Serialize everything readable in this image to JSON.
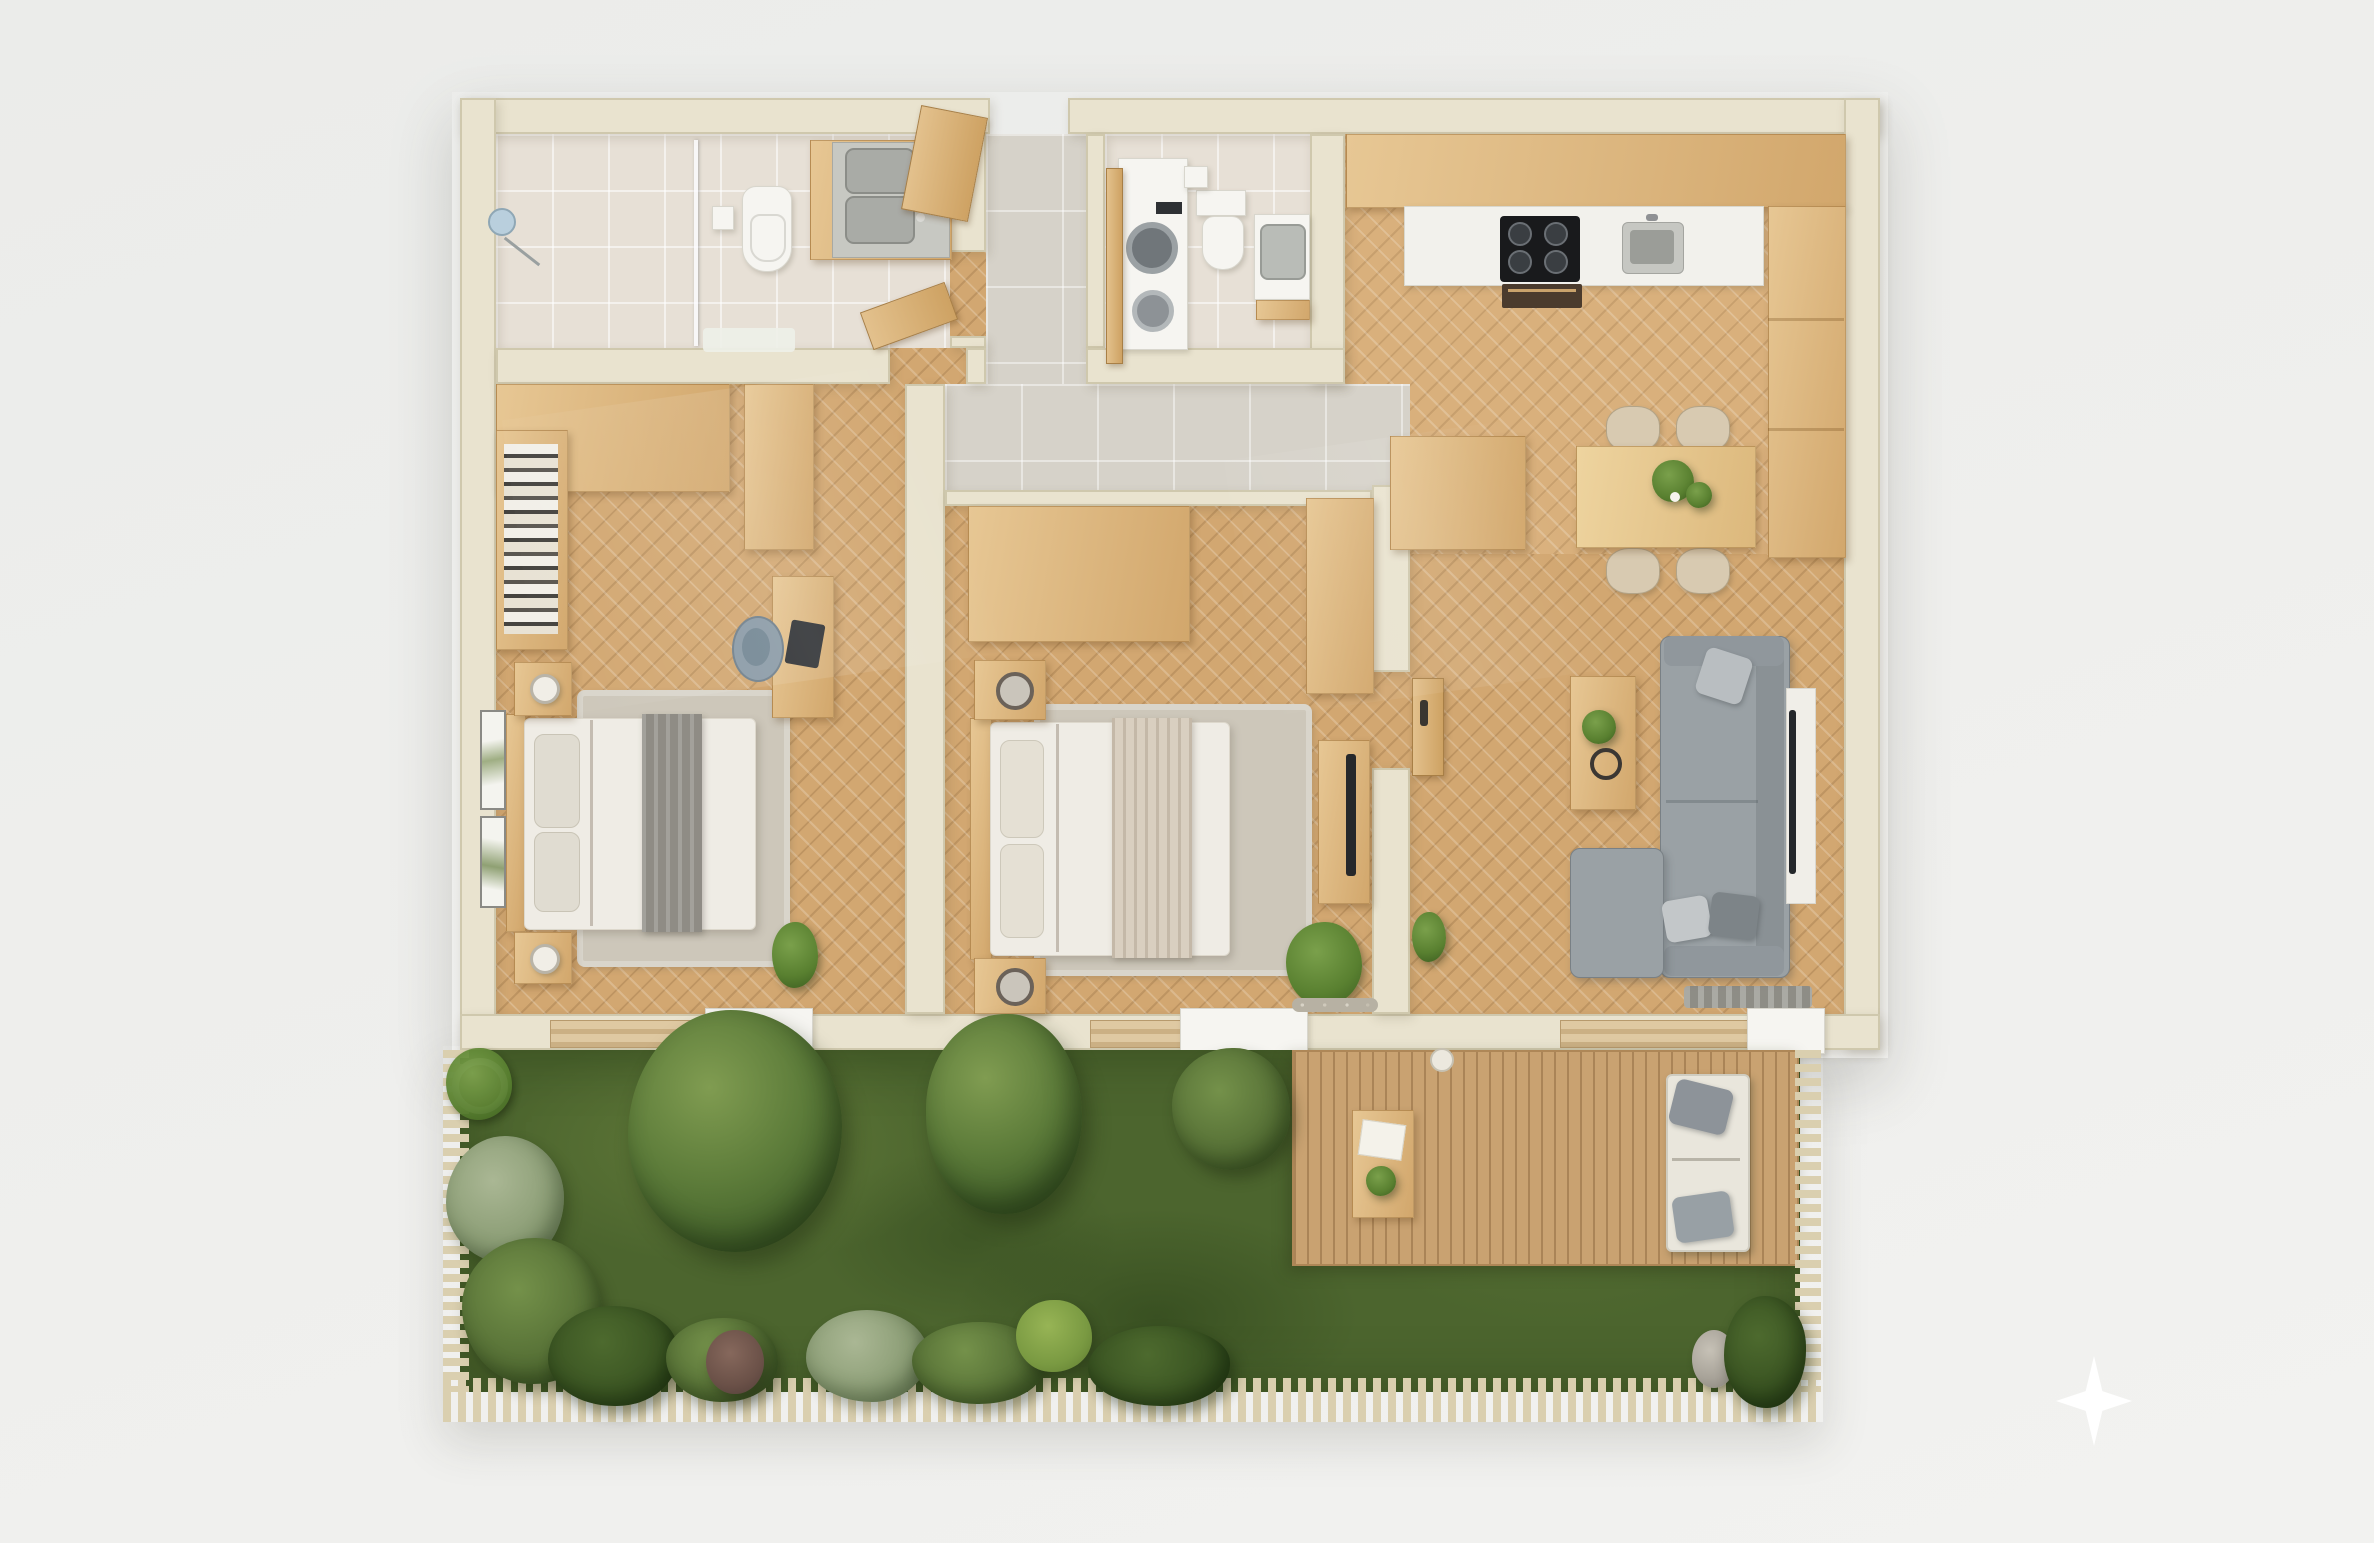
{
  "scene": {
    "kind": "3d-floor-plan-top-view",
    "description": "Photorealistic top-down 3D floor plan of a two-bedroom apartment with private garden and wooden deck",
    "text_labels": []
  },
  "palette": {
    "page_background": "#efefed",
    "wall_cream": "#e9e3cf",
    "herringbone_wood_floor": "#d2a771",
    "kitchen_wood_floor": "#d9b07c",
    "bathroom_tile": "#e7e0d6",
    "hall_tile": "#d6d2c9",
    "furniture_oak": "#ddb77f",
    "white_fixture": "#f6f5f1",
    "sofa_gray": "#9aa1a5",
    "bedding_white": "#efece5",
    "throw_gray": "#8f8c85",
    "throw_beige": "#d9cfc0",
    "grass_green": "#4c652e",
    "deck_wood": "#c9a271",
    "fence_slat": "#dacfaf",
    "sparkle_white": "#ffffff"
  },
  "rooms": [
    {
      "id": "bathroom",
      "items": [
        "walk-in-shower",
        "glass-partition",
        "shower-head",
        "wall-hung-toilet",
        "toilet-paper-holder",
        "double-sink-vanity",
        "bath-mat",
        "open-door-leaf"
      ]
    },
    {
      "id": "entry-hall",
      "items": [
        "entry-door-leaf",
        "tile-floor"
      ]
    },
    {
      "id": "wc-laundry",
      "items": [
        "washer-dryer-stack",
        "toilet-with-cistern",
        "corner-washbasin",
        "wood-shelf",
        "open-door-leaf"
      ]
    },
    {
      "id": "kitchen",
      "items": [
        "upper-cabinet-run",
        "white-countertop",
        "cooktop-4-burners",
        "oven",
        "kitchen-sink",
        "tall-cabinet-column",
        "corner-base-cabinet"
      ]
    },
    {
      "id": "dining-area",
      "items": [
        "rectangular-wood-table",
        "table-plant",
        "chair",
        "chair",
        "chair",
        "chair"
      ]
    },
    {
      "id": "living-room",
      "items": [
        "l-shaped-sectional-sofa",
        "throw-pillows",
        "coffee-table",
        "coffee-table-plant",
        "decorative-tray",
        "tv-on-wall",
        "door-mat"
      ]
    },
    {
      "id": "bedroom-1",
      "items": [
        "corner-wardrobe",
        "bookshelf",
        "desk",
        "laptop",
        "desk-chair",
        "double-bed",
        "gray-throw-blanket",
        "nightstand-with-lamp",
        "nightstand-with-lamp",
        "area-rug",
        "wall-art",
        "wall-art",
        "corner-plant"
      ]
    },
    {
      "id": "bedroom-2",
      "items": [
        "wardrobe",
        "side-wardrobe",
        "double-bed",
        "beige-throw-blanket",
        "nightstand-with-vase",
        "nightstand-with-vase",
        "area-rug",
        "media-dresser-with-tv",
        "corner-plant",
        "pebble-strip",
        "door-leaf-with-handle"
      ]
    },
    {
      "id": "garden",
      "items": [
        "lawn",
        "large-tree",
        "tree",
        "shrub-cluster",
        "silver-shrub",
        "dark-shrub",
        "purple-plant",
        "bright-moss-mound",
        "agave-in-white-pot",
        "perimeter-fence"
      ]
    },
    {
      "id": "terrace-deck",
      "items": [
        "plank-decking",
        "outdoor-dining-table",
        "white-tray",
        "deck-plant",
        "outdoor-sofa-white-cushions",
        "gray-outdoor-pillows",
        "stone-planter",
        "palm-plant"
      ]
    }
  ],
  "icons": [
    {
      "name": "sparkle-watermark-icon",
      "shape": "four-point-star",
      "color": "#ffffff"
    }
  ]
}
